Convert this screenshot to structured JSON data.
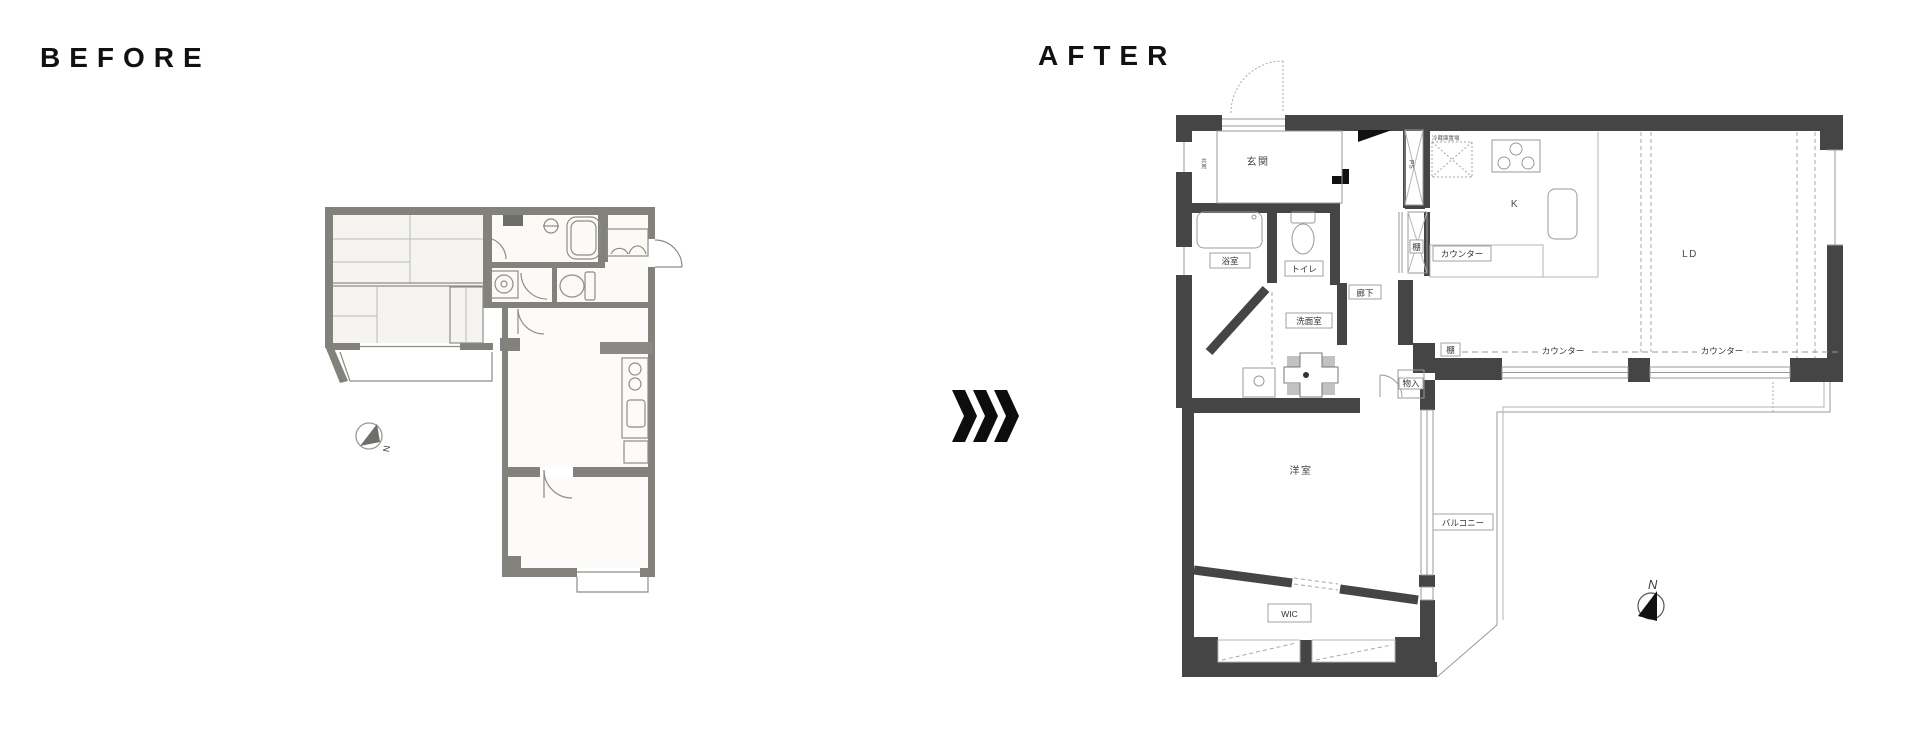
{
  "header": {
    "before_label": "BEFORE",
    "after_label": "AFTER"
  },
  "transition": {
    "icon": "triple-chevron-right",
    "color": "#0d0d0d"
  },
  "before_plan": {
    "description": "scanned pre-renovation floor plan",
    "wall_color": "#82817c",
    "compass_north": "N"
  },
  "after_plan": {
    "wall_color": "#454545",
    "labels": {
      "entrance": "玄関",
      "common_use": "共用",
      "bathroom": "浴室",
      "toilet": "トイレ",
      "washroom": "洗面室",
      "hallway": "廊下",
      "kitchen": "K",
      "living_dining": "LD",
      "counter_kitchen": "カウンター",
      "counter_ld_left": "カウンター",
      "counter_ld_right": "カウンター",
      "shelf_kitchen": "棚",
      "shelf_ld": "棚",
      "storage": "物入",
      "pipe_space": "PS",
      "fridge_space": "冷蔵庫置場",
      "western_room": "洋室",
      "walk_in_closet": "WIC",
      "balcony": "バルコニー",
      "compass_north": "N"
    }
  }
}
